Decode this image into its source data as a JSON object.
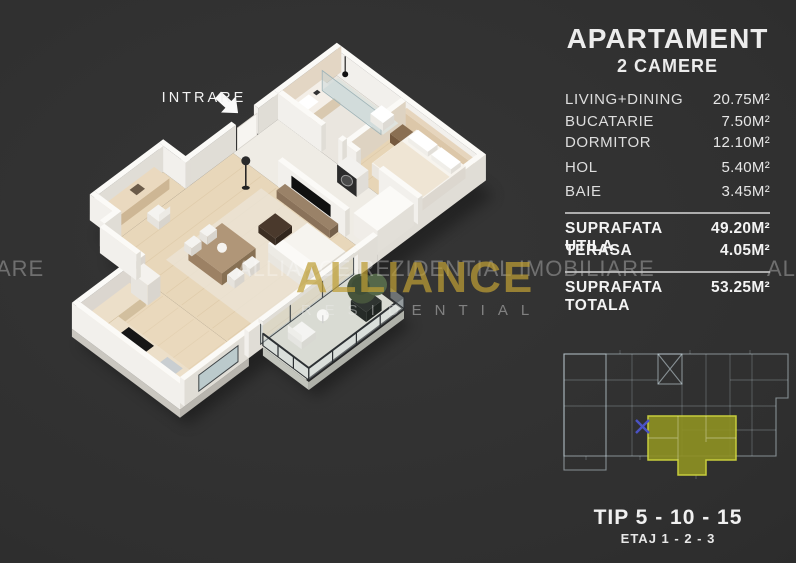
{
  "panel": {
    "title": "APARTAMENT",
    "subtitle": "2 CAMERE",
    "rooms": [
      {
        "label": "LIVING+DINING",
        "value": "20.75M²"
      },
      {
        "label": "BUCATARIE",
        "value": "7.50M²"
      },
      {
        "label": "DORMITOR",
        "value": "12.10M²"
      },
      {
        "label": "HOL",
        "value": "5.40M²"
      },
      {
        "label": "BAIE",
        "value": "3.45M²"
      }
    ],
    "totals": [
      {
        "label": "SUPRAFATA UTILA",
        "value": "49.20M²"
      },
      {
        "label": "TERASA",
        "value": "4.05M²"
      }
    ],
    "grand_total": {
      "label": "SUPRAFATA TOTALA",
      "value": "53.25M²"
    },
    "type_line": "TIP 5 - 10 - 15",
    "floor_line": "ETAJ 1 - 2 - 3",
    "highlight_color": "#8f9222",
    "highlight_stroke": "#d8de3e"
  },
  "floorplan": {
    "entrance_label": "INTRARE"
  },
  "watermark": {
    "left_fragment": "ARE",
    "text": "ALLIANCE REZIDENTIAL IMOBILIARE",
    "right_fragment": "ALL",
    "logo_text": "ALLIANCE",
    "logo_subtext": "RESIDENTIAL",
    "logo_color": "#be9e34"
  },
  "colors": {
    "background": "#2f2f2f",
    "panel_text": "#e9e9e9",
    "watermark": "rgba(255,255,255,0.30)"
  }
}
